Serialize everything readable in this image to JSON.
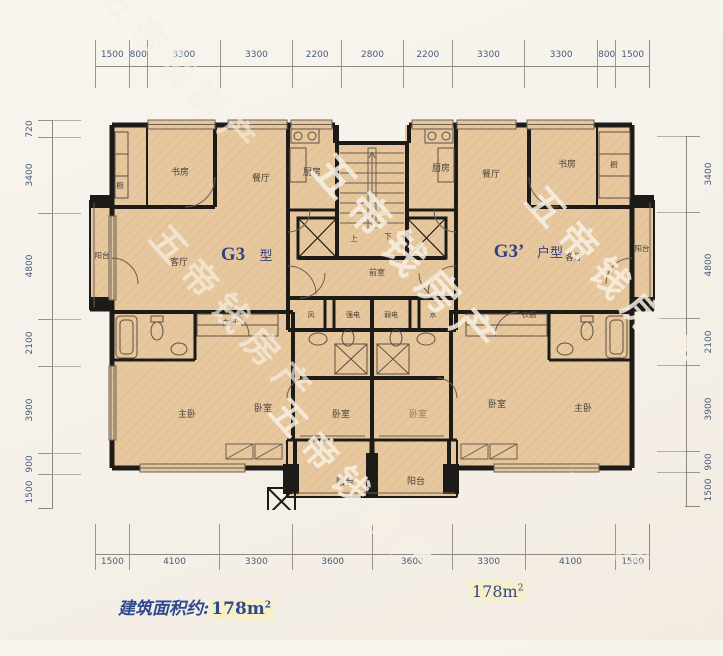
{
  "watermark": {
    "text": "五帝钱房产"
  },
  "dimensions": {
    "top": [
      "1500",
      "800",
      "3300",
      "3300",
      "2200",
      "2800",
      "2200",
      "3300",
      "3300",
      "800",
      "1500"
    ],
    "bottom": [
      "1500",
      "4100",
      "3300",
      "3600",
      "3600",
      "3300",
      "4100",
      "1500"
    ],
    "left": [
      "720",
      "3400",
      "4800",
      "2100",
      "3900",
      "900",
      "1500"
    ],
    "right": [
      "3400",
      "4800",
      "2100",
      "3900",
      "900",
      "1500"
    ]
  },
  "plan": {
    "unit_left": {
      "name": "G3",
      "suffix": "型"
    },
    "unit_right": {
      "name": "G3’",
      "suffix": "户型"
    },
    "rooms": {
      "study": "书房",
      "dining": "餐厅",
      "kitchen": "厨房",
      "living": "客厅",
      "balcony": "阳台",
      "master": "主卧",
      "bedroom": "卧室",
      "wardrobe": "衣橱",
      "cabinet": "橱",
      "lobby": "前室",
      "vent": "风",
      "strong_elec": "强电",
      "weak_elec": "弱电",
      "water": "水",
      "up": "上",
      "down": "下"
    }
  },
  "footer": {
    "left_label": "建筑面积约:",
    "left_area": "178m",
    "left_sup": "2",
    "right_area": "178m",
    "right_sup": "2"
  },
  "colors": {
    "floor": "#e7c79e",
    "wall": "#1d1b18",
    "dim_text": "#4a5b7c",
    "unit_label": "#323f86"
  }
}
